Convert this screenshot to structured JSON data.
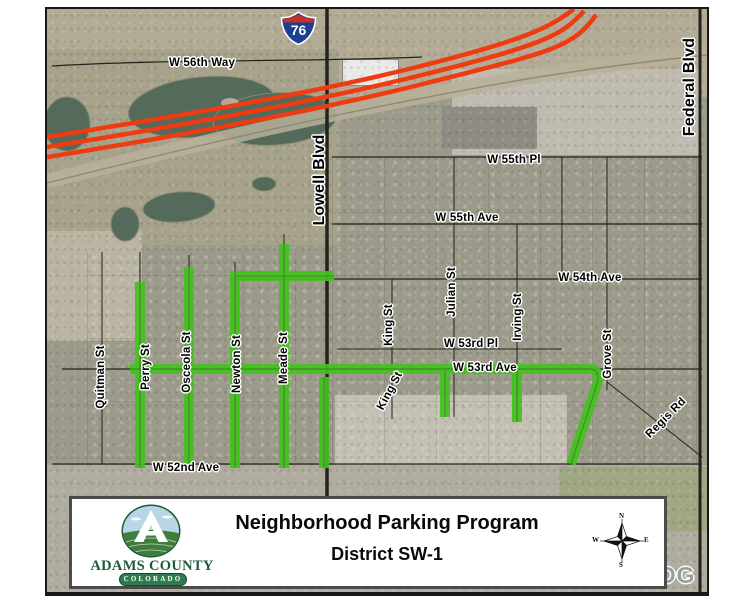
{
  "map": {
    "highway_shield": {
      "route": "76"
    },
    "street_labels": [
      {
        "id": "w56th-way",
        "text": "W 56th Way"
      },
      {
        "id": "lowell-blvd",
        "text": "Lowell Blvd"
      },
      {
        "id": "federal-blvd",
        "text": "Federal Blvd"
      },
      {
        "id": "w55th-pl",
        "text": "W 55th Pl"
      },
      {
        "id": "w55th-ave",
        "text": "W 55th Ave"
      },
      {
        "id": "w54th-ave",
        "text": "W 54th Ave"
      },
      {
        "id": "quitman-st",
        "text": "Quitman St"
      },
      {
        "id": "perry-st",
        "text": "Perry St"
      },
      {
        "id": "osceola-st",
        "text": "Osceola St"
      },
      {
        "id": "newton-st",
        "text": "Newton St"
      },
      {
        "id": "meade-st",
        "text": "Meade St"
      },
      {
        "id": "king-st-north",
        "text": "King St"
      },
      {
        "id": "king-st-south",
        "text": "King St"
      },
      {
        "id": "julian-st",
        "text": "Julian St"
      },
      {
        "id": "irving-st",
        "text": "Irving St"
      },
      {
        "id": "grove-st",
        "text": "Grove St"
      },
      {
        "id": "regis-rd",
        "text": "Regis Rd"
      },
      {
        "id": "w53rd-pl",
        "text": "W 53rd Pl"
      },
      {
        "id": "w53rd-ave",
        "text": "W 53rd Ave"
      },
      {
        "id": "w52nd-ave",
        "text": "W 52nd Ave"
      }
    ],
    "highlighted_streets": [
      "Perry St",
      "Osceola St",
      "Newton St",
      "Meade St",
      "W 54th Ave (Newton St to Lowell Blvd)",
      "W 53rd Ave (Perry St to Grove St)",
      "Julian St (south of W 53rd Ave)",
      "Irving St (south of W 53rd Ave)",
      "segment west of Lowell Blvd (W 53rd Ave to W 52nd Ave)",
      "diagonal segment at Grove St / Regis Rd"
    ],
    "colors": {
      "highlight_green": "#44c21e",
      "highway_red": "#ee3b12",
      "water": "#546a5a",
      "terrain_base": "#9c9a8a"
    }
  },
  "watermark": {
    "text": "DG"
  },
  "title_block": {
    "title_line1": "Neighborhood Parking Program",
    "title_line2": "District SW-1",
    "logo": {
      "name": "ADAMS COUNTY",
      "sub": "COLORADO"
    },
    "compass": {
      "n": "N",
      "e": "E",
      "s": "S",
      "w": "W"
    }
  }
}
